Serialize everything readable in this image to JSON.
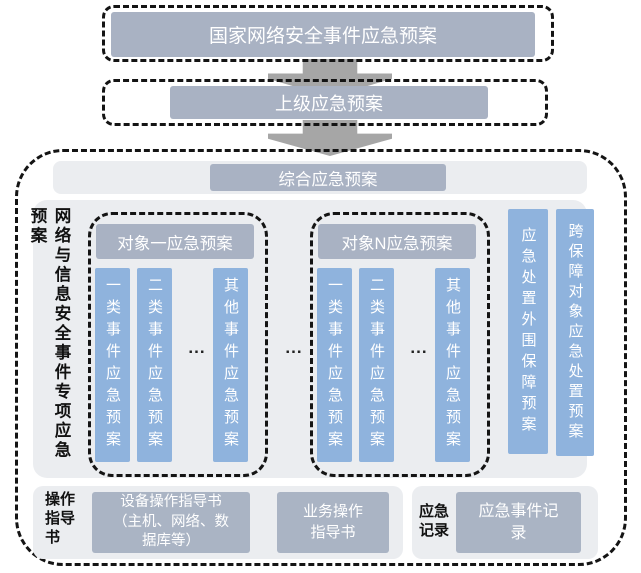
{
  "diagram": {
    "national_plan": "国家网络安全事件应急预案",
    "superior_plan": "上级应急预案",
    "comprehensive_plan": "综合应急预案",
    "side_label": "网络与信息安全事件专项应急预案",
    "groups": [
      {
        "title": "对象一应急预案",
        "bars": [
          "一类事件应急预案",
          "二类事件应急预案",
          "其他事件应急预案"
        ],
        "ellipsis": "..."
      },
      {
        "title": "对象N应急预案",
        "bars": [
          "一类事件应急预案",
          "二类事件应急预案",
          "其他事件应急预案"
        ],
        "ellipsis": "..."
      }
    ],
    "groups_separator": "...",
    "support_bars": [
      "应急处置外围保障预案",
      "跨保障对象应急处置预案"
    ],
    "operations": {
      "label": "操作\n指导\n书",
      "device_box": "设备操作指导书\n（主机、网络、数\n据库等）",
      "business_box": "业务操作\n指导书"
    },
    "records": {
      "label": "应急\n记录",
      "box": "应急事件记\n录"
    },
    "colors": {
      "box_fill": "#a9b2c3",
      "bar_fill": "#8fb3dd",
      "panel_bg": "#ebedf0",
      "arrow_gray": "#a6a6a6",
      "dash_black": "#141414"
    }
  }
}
